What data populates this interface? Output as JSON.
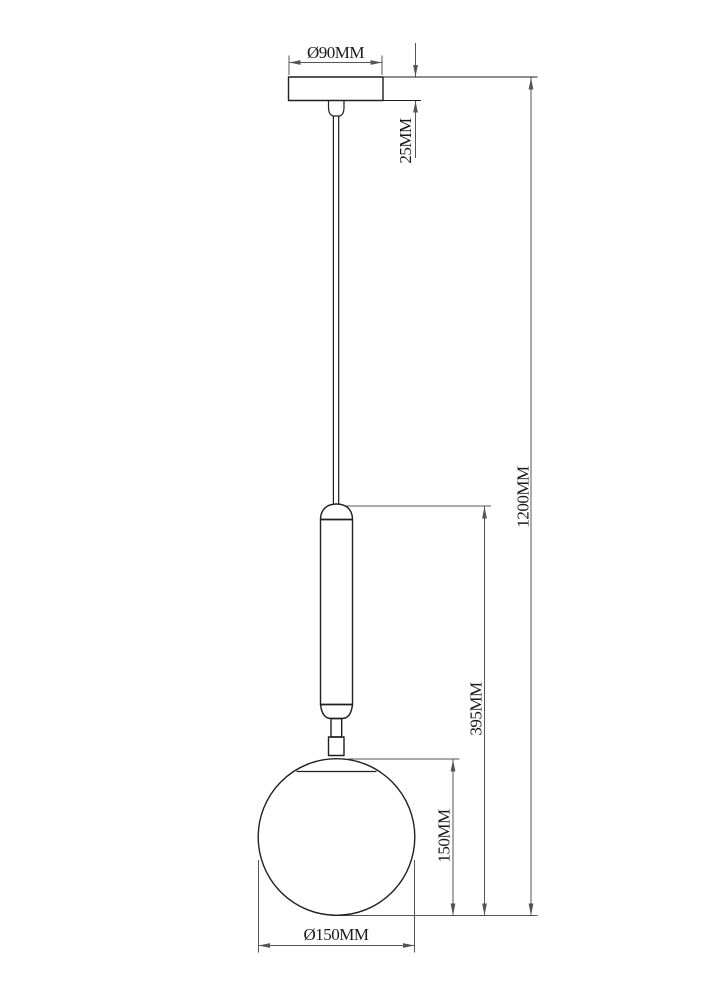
{
  "drawing": {
    "subject": "pendant-lamp-globe-technical-drawing",
    "colors": {
      "background": "#ffffff",
      "outline": "#1f1f1f",
      "dimension": "#555555",
      "text": "#1a1a1a"
    },
    "labels": {
      "canopy_diameter": "Ø90MM",
      "canopy_height": "25MM",
      "overall_drop": "1200MM",
      "body_height": "395MM",
      "globe_height": "150MM",
      "globe_diameter": "Ø150MM"
    }
  }
}
